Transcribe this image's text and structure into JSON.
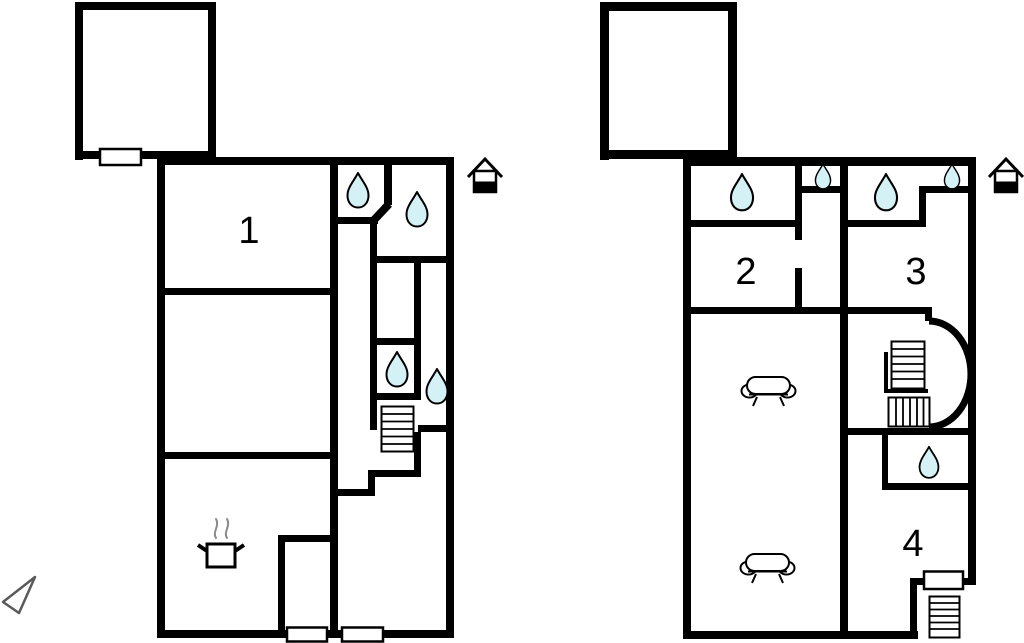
{
  "colors": {
    "background": "#ffffff",
    "walls": "#000000",
    "water_drop_fill": "#d4f2f6",
    "steam_gray": "#8a8a8a",
    "compass_outline": "#5a5a5a"
  },
  "plans": [
    {
      "id": "left-floor-plan",
      "rooms": [
        {
          "number": "1"
        }
      ],
      "fixtures": {
        "water_drop_icons": 4,
        "staircase_icons": 1,
        "cooking_pot_icons": 1,
        "entrance_house_icons": 1,
        "window_markers": 1,
        "door_markers": 2,
        "annex_outbuildings": 1
      }
    },
    {
      "id": "right-floor-plan",
      "rooms": [
        {
          "number": "2"
        },
        {
          "number": "3"
        },
        {
          "number": "4"
        }
      ],
      "fixtures": {
        "water_drop_icons": 5,
        "staircase_icons": 3,
        "sofa_icons": 2,
        "entrance_house_icons": 1,
        "door_markers": 1,
        "curved_stair_arcs": 1,
        "annex_outbuildings": 1
      }
    }
  ],
  "compass": {
    "type": "north-arrow-triangle"
  }
}
